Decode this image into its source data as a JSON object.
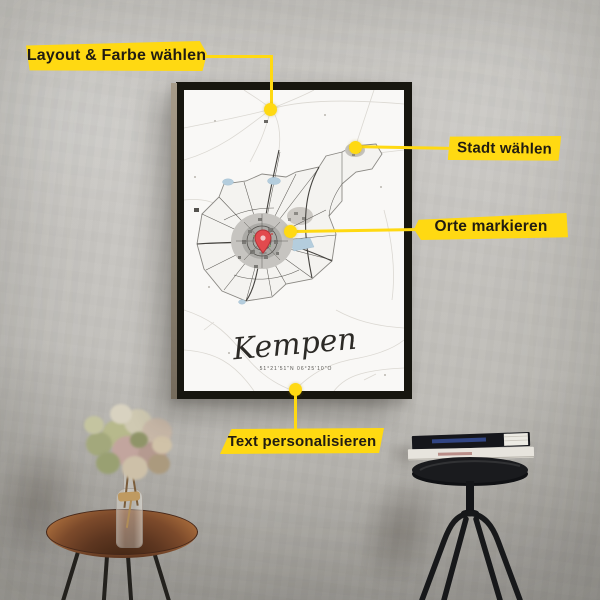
{
  "callouts": {
    "layout": {
      "label": "Layout & Farbe wählen"
    },
    "city": {
      "label": "Stadt wählen"
    },
    "places": {
      "label": "Orte markieren"
    },
    "personalize": {
      "label": "Text personalisieren"
    }
  },
  "poster": {
    "title": "Kempen",
    "coordinates": "51°21'51\"N 06°25'10\"O"
  },
  "colors": {
    "accent_yellow": "#FFD912",
    "callout_text": "#211C12",
    "frame_black": "#17160F",
    "poster_white": "#F9F8F6",
    "map_pin_red": "#E24A4E",
    "lake_blue": "#B4CDDD",
    "wall_gray": "#C6C4C0"
  }
}
